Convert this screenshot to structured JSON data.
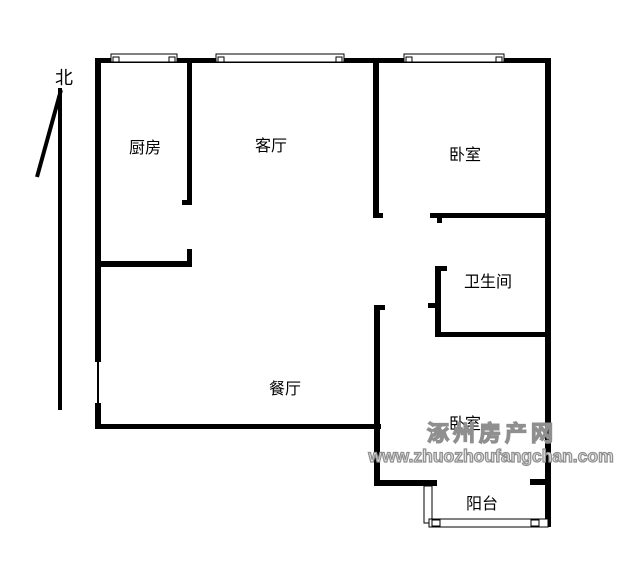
{
  "compass": {
    "label": "北"
  },
  "rooms": {
    "kitchen": "厨房",
    "living_room": "客厅",
    "bedroom_north": "卧室",
    "bathroom": "卫生间",
    "dining_room": "餐厅",
    "bedroom_south": "卧室",
    "balcony": "阳台"
  },
  "watermark": {
    "site_name": "涿州房产网",
    "site_url": "www.zhuozhoufangchan.com"
  },
  "colors": {
    "background": "#ffffff",
    "wall": "#000000",
    "label_text": "#000000",
    "watermark_stroke": "#8f8f8f",
    "watermark_fill": "#e3e3e3"
  }
}
